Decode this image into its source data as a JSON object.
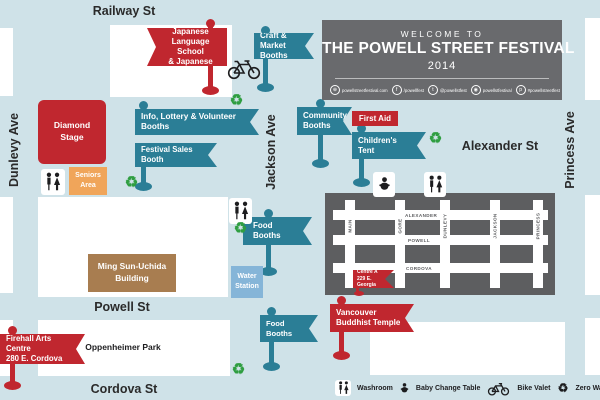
{
  "streets": {
    "railway": "Railway St",
    "dunlevy": "Dunlevy Ave",
    "jackson": "Jackson Ave",
    "princess": "Princess Ave",
    "alexander": "Alexander St",
    "powell": "Powell St",
    "cordova": "Cordova St"
  },
  "header": {
    "welcome": "WELCOME TO",
    "title": "THE POWELL STREET FESTIVAL",
    "year": "2014",
    "social": [
      {
        "glyph": "⊕",
        "text": "powellstreetfestival.com"
      },
      {
        "glyph": "f",
        "text": "/powellfest"
      },
      {
        "glyph": "t",
        "text": "@powellstfest"
      },
      {
        "glyph": "◉",
        "text": "powellstfestival"
      },
      {
        "glyph": "p",
        "text": "#powellstreetfest"
      }
    ]
  },
  "flags": {
    "vjls": {
      "l1": "Vancouver Japanese",
      "l2": "Language School",
      "l3": "& Japanese Hall"
    },
    "craft": {
      "l1": "Craft & Market",
      "l2": "Booths"
    },
    "info": {
      "l1": "Info, Lottery & Volunteer Booths"
    },
    "sales": {
      "l1": "Festival Sales Booth"
    },
    "community": {
      "l1": "Community",
      "l2": "Booths"
    },
    "first_aid": {
      "l1": "First Aid"
    },
    "childrens": {
      "l1": "Children's Tent"
    },
    "food_upper": {
      "l1": "Food Booths"
    },
    "food_lower": {
      "l1": "Food Booths"
    },
    "buddhist": {
      "l1": "Vancouver",
      "l2": "Buddhist Temple"
    },
    "firehall": {
      "l1": "Firehall Arts Centre",
      "l2": "280 E. Cordova"
    },
    "centre_a": {
      "l1": "Centre A",
      "l2": "229 E. Georgia"
    }
  },
  "areas": {
    "diamond_stage": {
      "l1": "Diamond",
      "l2": "Stage"
    },
    "seniors": {
      "l1": "Seniors",
      "l2": "Area"
    },
    "ming_sun": {
      "l1": "Ming Sun-Uchida",
      "l2": "Building"
    },
    "water": {
      "l1": "Water",
      "l2": "Station"
    },
    "oppenheimer": "Oppenheimer Park"
  },
  "inset": {
    "h_streets": [
      "ALEXANDER",
      "POWELL",
      "CORDOVA"
    ],
    "v_streets": [
      "MAIN",
      "GORE",
      "DUNLEVY",
      "JACKSON",
      "PRINCESS"
    ]
  },
  "legend": [
    {
      "icon": "washroom-icon",
      "label": "Washroom"
    },
    {
      "icon": "baby-change-icon",
      "label": "Baby Change Table"
    },
    {
      "icon": "bike-valet-icon",
      "label": "Bike Valet"
    },
    {
      "icon": "zero-waste-icon",
      "label": "Zero Waste Station"
    }
  ],
  "glyphs": {
    "recycle": "♻"
  },
  "colors": {
    "background": "#cfe2e8",
    "block_white": "#ffffff",
    "teal": "#2b7e96",
    "red": "#c0272f",
    "orange": "#f0a55a",
    "tan": "#a87d50",
    "water_blue": "#85b5d8",
    "green": "#2f9e41",
    "gray_header": "#696a6d",
    "gray_inset": "#5d5e60"
  }
}
